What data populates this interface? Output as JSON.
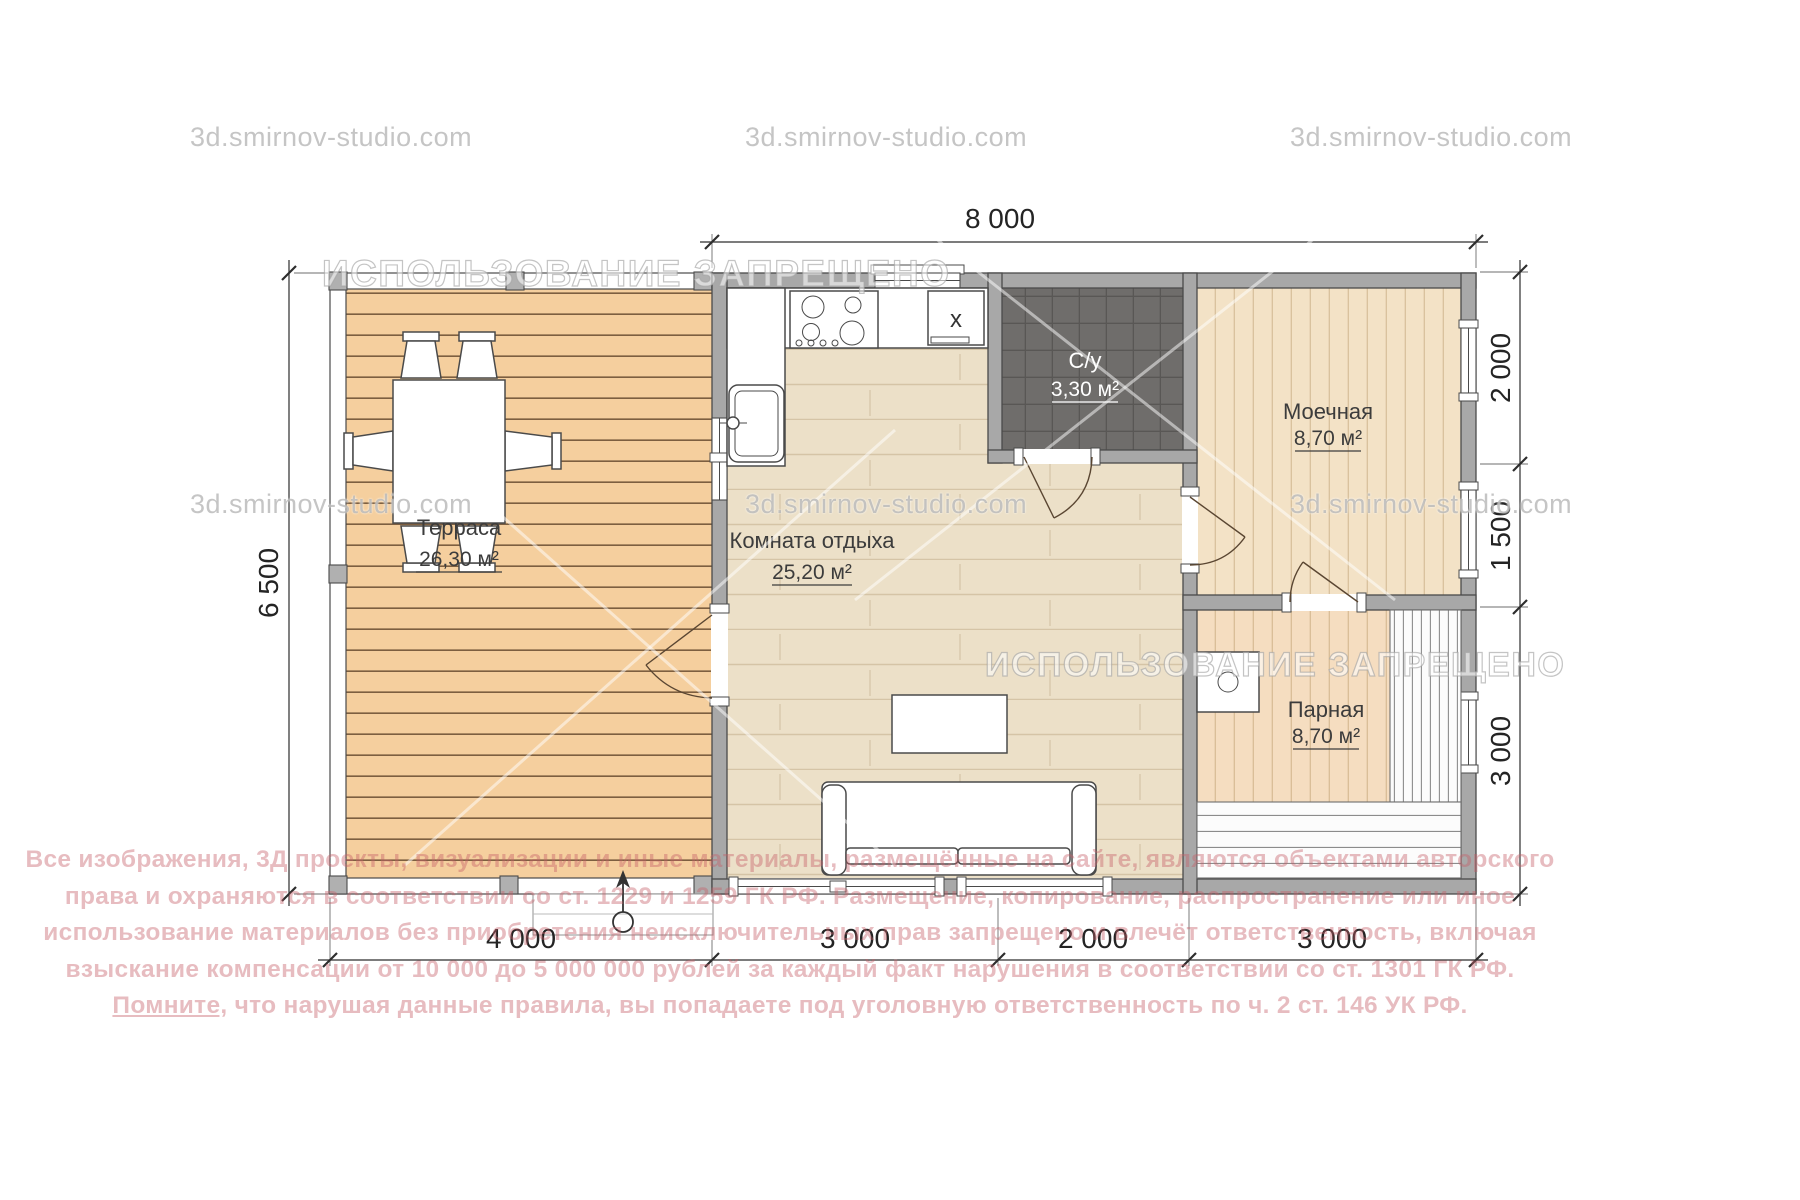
{
  "plan": {
    "rooms": {
      "terrace": {
        "name": "Терраса",
        "area": "26,30 м²"
      },
      "lounge": {
        "name": "Комната отдыха",
        "area": "25,20 м²"
      },
      "su": {
        "name": "С/у",
        "area": "3,30 м²"
      },
      "washroom": {
        "name": "Моечная",
        "area": "8,70 м²"
      },
      "steam": {
        "name": "Парная",
        "area": "8,70 м²"
      }
    },
    "dims": {
      "top": "8 000",
      "left": "6 500",
      "right": [
        "2 000",
        "1 500",
        "3 000"
      ],
      "bottom": [
        "4 000",
        "3 000",
        "2 000",
        "3 000"
      ]
    },
    "fridge_label": "x"
  },
  "watermarks": {
    "site": "3d.smirnov-studio.com",
    "banner": "ИСПОЛЬЗОВАНИЕ ЗАПРЕЩЕНО"
  },
  "copyright": {
    "lines": [
      "Все изображения, 3Д проекты, визуализации и иные материалы, размещённые на сайте, являются объектами авторского",
      "права и охраняются в соответствии со ст. 1229 и 1259 ГК РФ. Размещение, копирование, распространение или иное",
      "использование материалов без приобретения неисключительных прав запрещено и влечёт ответственность, включая",
      "взыскание компенсации от 10 000 до 5 000 000 рублей за каждый факт нарушения в соответствии со ст. 1301 ГК РФ."
    ],
    "line5_lead": "Помните,",
    "line5_rest": " что нарушая данные правила, вы попадаете под уголовную ответственность по ч. 2 ст. 146 УК РФ."
  },
  "colors": {
    "wall_gray": "#a8a8a8",
    "terrace_wood": "#f5cf9e",
    "parquet": "#ece0c8",
    "planks_light": "#f3e2c6",
    "tile_dark": "#6f6d6b",
    "copyright_pink": "#c4626c",
    "watermark_gray": "#b2b2b2"
  }
}
